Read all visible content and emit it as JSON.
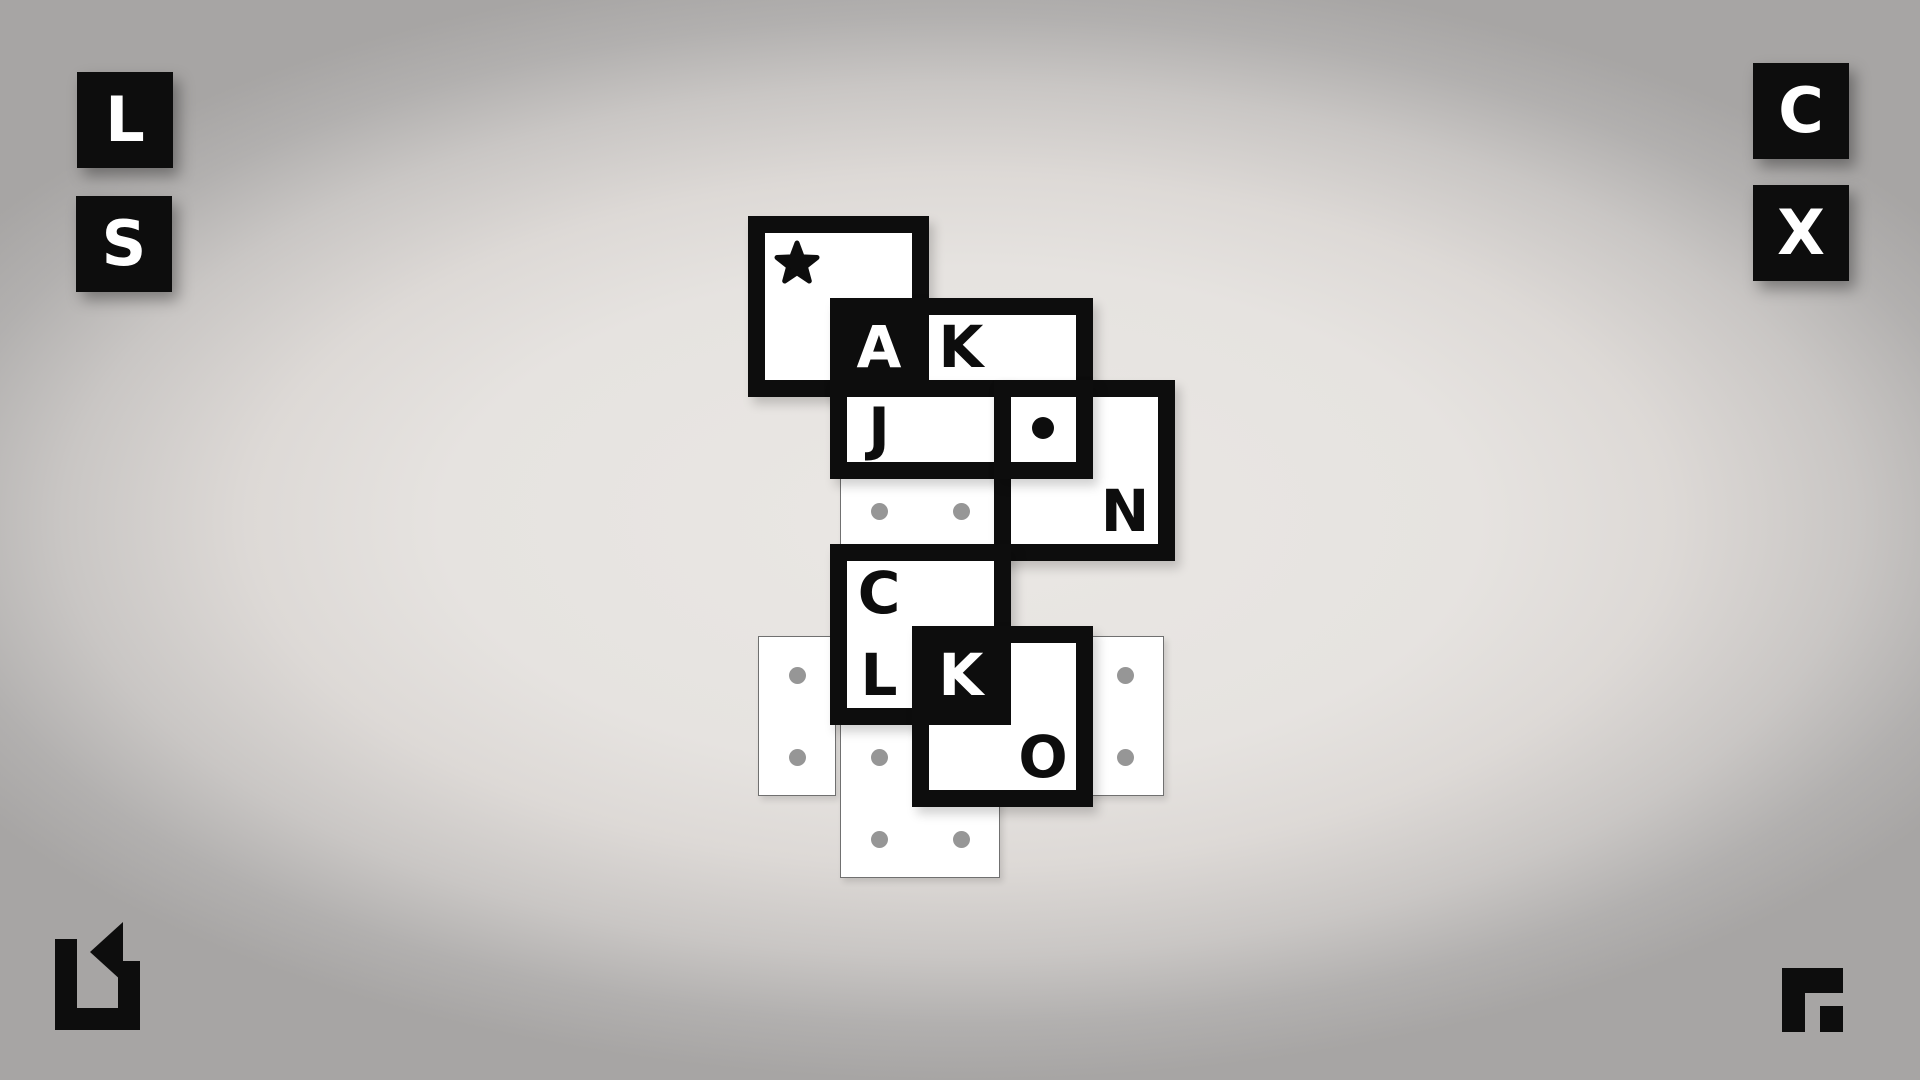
{
  "screen": {
    "kind": "puzzle-game-board"
  },
  "colors": {
    "ink": "#0d0d0d",
    "paper": "#ffffff",
    "gray_dot": "#969696",
    "tile_border": "#707070",
    "bg_center": "#eae7e4",
    "bg_edge": "#a7a5a4"
  },
  "buttons": {
    "l": {
      "label": "L",
      "x": 77,
      "y": 72
    },
    "s": {
      "label": "S",
      "x": 76,
      "y": 196
    },
    "c": {
      "label": "C",
      "x": 1753,
      "y": 63
    },
    "x": {
      "label": "X",
      "x": 1753,
      "y": 185
    }
  },
  "footer_icons": {
    "undo": {
      "name": "undo-arrow-icon",
      "x": 55,
      "y": 922,
      "w": 85,
      "h": 108
    },
    "logo": {
      "name": "developer-logo-icon",
      "x": 1782,
      "y": 968,
      "w": 61,
      "h": 64
    }
  },
  "puzzle": {
    "unit": 82,
    "frame_border": 17,
    "frames": [
      {
        "name": "frame-star",
        "x": 756,
        "y": 224,
        "w": 164,
        "h": 164
      },
      {
        "name": "frame-ak",
        "x": 838,
        "y": 306,
        "w": 246,
        "h": 82
      },
      {
        "name": "frame-j",
        "x": 838,
        "y": 388,
        "w": 164,
        "h": 82
      },
      {
        "name": "frame-dot-n",
        "x": 1002,
        "y": 388,
        "w": 164,
        "h": 164
      },
      {
        "name": "frame-dot",
        "x": 1002,
        "y": 388,
        "w": 82,
        "h": 82
      },
      {
        "name": "frame-cl",
        "x": 838,
        "y": 552,
        "w": 164,
        "h": 164
      },
      {
        "name": "frame-ko",
        "x": 920,
        "y": 634,
        "w": 164,
        "h": 164
      }
    ],
    "black_cells": [
      {
        "name": "cell-a-filled",
        "x": 838,
        "y": 306,
        "w": 82,
        "h": 82
      },
      {
        "name": "cell-k2-filled",
        "x": 920,
        "y": 634,
        "w": 82,
        "h": 82
      }
    ],
    "letters": [
      {
        "char": "A",
        "cx": 879,
        "cy": 347,
        "tone": "white"
      },
      {
        "char": "K",
        "cx": 961,
        "cy": 347,
        "tone": "black"
      },
      {
        "char": "J",
        "cx": 879,
        "cy": 429,
        "tone": "black"
      },
      {
        "char": "N",
        "cx": 1125,
        "cy": 511,
        "tone": "black"
      },
      {
        "char": "C",
        "cx": 879,
        "cy": 593,
        "tone": "black"
      },
      {
        "char": "L",
        "cx": 879,
        "cy": 675,
        "tone": "black"
      },
      {
        "char": "K",
        "cx": 961,
        "cy": 675,
        "tone": "white"
      },
      {
        "char": "O",
        "cx": 1043,
        "cy": 757,
        "tone": "black"
      }
    ],
    "symbols": [
      {
        "type": "star",
        "name": "star-icon",
        "cx": 797,
        "cy": 264,
        "size": 48
      },
      {
        "type": "dot",
        "name": "black-dot-icon",
        "cx": 1043,
        "cy": 428,
        "r": 11
      }
    ],
    "thin_tiles": [
      {
        "name": "tile-bg-dots-row",
        "x": 838,
        "y": 470,
        "w": 164,
        "h": 82
      },
      {
        "name": "tile-bg-left",
        "x": 756,
        "y": 634,
        "w": 82,
        "h": 164
      },
      {
        "name": "tile-bg-bottom",
        "x": 838,
        "y": 716,
        "w": 164,
        "h": 164
      },
      {
        "name": "tile-bg-right",
        "x": 1084,
        "y": 634,
        "w": 82,
        "h": 164
      }
    ],
    "gray_dots": [
      {
        "cx": 879,
        "cy": 511
      },
      {
        "cx": 961,
        "cy": 511
      },
      {
        "cx": 797,
        "cy": 675
      },
      {
        "cx": 797,
        "cy": 757
      },
      {
        "cx": 879,
        "cy": 757
      },
      {
        "cx": 879,
        "cy": 839
      },
      {
        "cx": 961,
        "cy": 839
      },
      {
        "cx": 1125,
        "cy": 675
      },
      {
        "cx": 1125,
        "cy": 757
      }
    ]
  }
}
